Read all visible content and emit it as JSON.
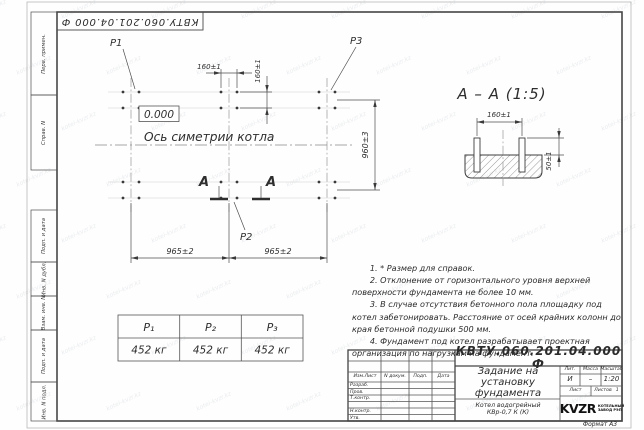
{
  "sheet": {
    "stamp_top": "КВТУ.060.201.04.000 Ф",
    "format_label": "Формат А3",
    "watermark": "kotel-kvzr.kz"
  },
  "margin_labels": [
    "Перв. примен.",
    "Справ. N",
    "Подп. и дата",
    "Инв. N дубл.",
    "Взам. инв. N",
    "Подп. и дата",
    "Инв. N подл."
  ],
  "plan": {
    "p1": "P1",
    "p2": "P2",
    "p3": "P3",
    "elevation": "0.000",
    "axis_label": "Ось симетрии котла",
    "dim_160_h": "160±1",
    "dim_160_v": "160±1",
    "dim_965_left": "965±2",
    "dim_965_right": "965±2",
    "dim_960": "960±3",
    "section_letter": "А"
  },
  "section": {
    "title": "А – А (1:5)",
    "dim_160": "160±1",
    "dim_50": "50±1"
  },
  "notes": [
    "1. * Размер для справок.",
    "2. Отклонение от горизонтального уровня верхней поверхности фундамента не более 10 мм.",
    "3. В случае отсутствия бетонного пола площадку под котел забетонировать. Расстояние от осей крайних колонн до края бетонной подушки 500 мм.",
    "4. Фундамент под котел разрабатывает проектная организация по нагрузкам на фундамент."
  ],
  "load_table": {
    "headers": [
      "P₁",
      "P₂",
      "P₃"
    ],
    "values": [
      "452 кг",
      "452 кг",
      "452 кг"
    ]
  },
  "title_block": {
    "doc_number": "КВТУ.060.201.04.000 Ф",
    "title": "Задание на установку фундамента",
    "product": "Котел водогрейный КВр-0,7 К (К)",
    "header_cols": [
      "Изм.Лист",
      "N докум.",
      "Подп.",
      "Дата"
    ],
    "row_labels": [
      "Разраб.",
      "Пров.",
      "Т.контр.",
      "",
      "Н.контр.",
      "Утв."
    ],
    "lit_label": "Лит.",
    "lit_value": "И",
    "mass_label": "Масса",
    "mass_value": "–",
    "scale_label": "Масштаб",
    "scale_value": "1:20",
    "sheet_label": "Лист",
    "sheets_label": "Листов",
    "sheets_value": "1",
    "logo_text": "KVZR",
    "logo_sub1": "КОТЕЛЬНЫЙ",
    "logo_sub2": "ЗАВОД РЭП"
  }
}
